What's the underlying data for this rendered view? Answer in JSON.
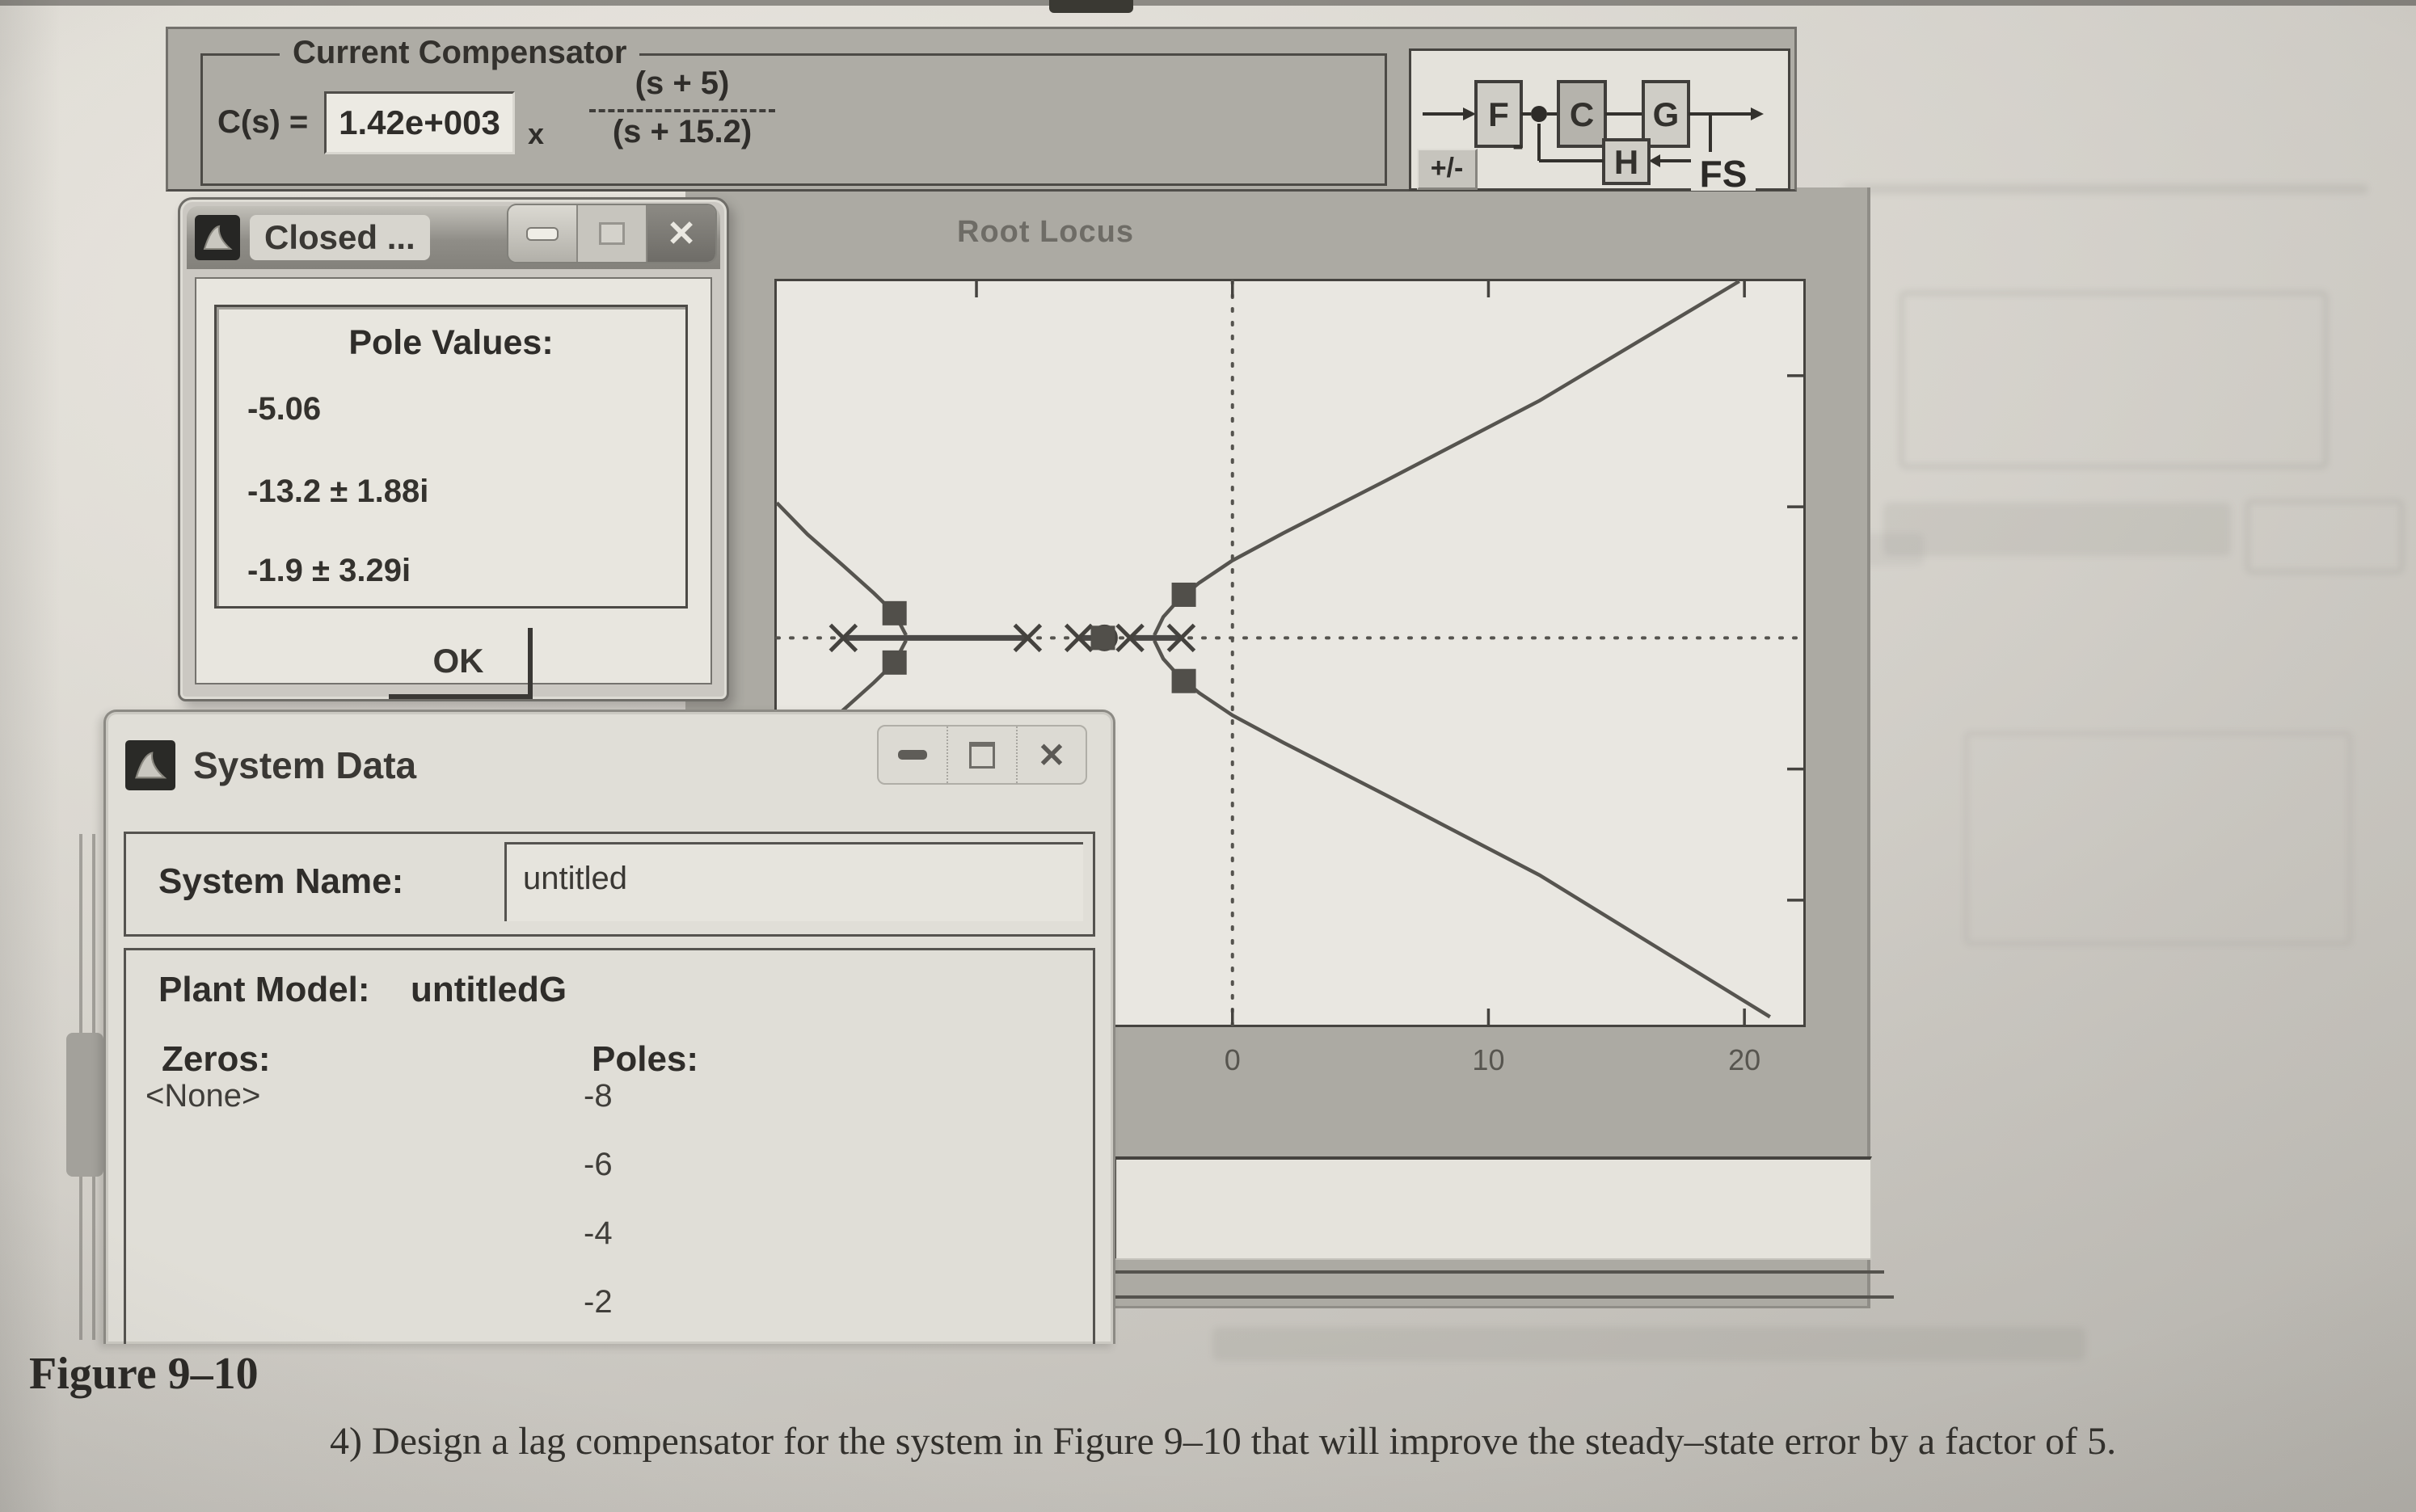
{
  "page": {
    "figure_label": "Figure 9–10",
    "problem_text": "4) Design a lag compensator for the system in Figure 9–10 that will improve the steady–state error by a factor of 5."
  },
  "compensator": {
    "group_label": "Current Compensator",
    "cs_label": "C(s) =",
    "gain_value": "1.42e+003",
    "multiply_sign": "x",
    "numerator": "(s + 5)",
    "denominator": "(s + 15.2)"
  },
  "block_diagram": {
    "block_f": "F",
    "block_c": "C",
    "block_g": "G",
    "block_h": "H",
    "minus_sign": "-",
    "sign_toggle_label": "+/-",
    "fs_label": "FS"
  },
  "closed_dialog": {
    "title": "Closed ...",
    "heading": "Pole Values:",
    "values": [
      "-5.06",
      "-13.2 ± 1.88i",
      "-1.9 ± 3.29i"
    ],
    "ok_label": "OK",
    "close_glyph": "✕"
  },
  "system_data": {
    "title": "System Data",
    "name_label": "System Name:",
    "name_value": "untitled",
    "plant_label": "Plant Model:",
    "plant_value": "untitledG",
    "zeros_label": "Zeros:",
    "zeros": [
      "<None>"
    ],
    "poles_label": "Poles:",
    "poles": [
      "-8",
      "-6",
      "-4",
      "-2"
    ],
    "close_glyph": "✕"
  },
  "chart_data": {
    "type": "scatter",
    "title": "Root Locus",
    "xlabel": "",
    "ylabel": "",
    "xlim": [
      -17.8,
      22.3
    ],
    "ylim": [
      -29.5,
      27.2
    ],
    "grid": false,
    "axes_dashed": true,
    "x_ticks": [
      -10,
      0,
      10,
      20
    ],
    "x_tick_labels": [
      {
        "value": 0,
        "label": "0"
      },
      {
        "value": 10,
        "label": "10"
      },
      {
        "value": 20,
        "label": "20"
      }
    ],
    "y_ticks": [
      -20,
      -10,
      10,
      20
    ],
    "open_loop_poles": [
      [
        -15.2,
        0
      ],
      [
        -8,
        0
      ],
      [
        -6,
        0
      ],
      [
        -4,
        0
      ],
      [
        -2,
        0
      ]
    ],
    "open_loop_zeros": [
      [
        -5,
        0
      ]
    ],
    "closed_loop_poles": [
      [
        -5.06,
        0
      ],
      [
        -13.2,
        1.88
      ],
      [
        -13.2,
        -1.88
      ],
      [
        -1.9,
        3.29
      ],
      [
        -1.9,
        -3.29
      ]
    ],
    "real_axis_segments": [
      [
        -15.2,
        -8
      ],
      [
        -6,
        -5
      ],
      [
        -4,
        -2
      ]
    ],
    "branches": [
      [
        [
          -3.05,
          0.2
        ],
        [
          -2.7,
          1.6
        ],
        [
          -2.1,
          2.9
        ],
        [
          -1.3,
          4.2
        ],
        [
          0,
          5.9
        ],
        [
          2,
          8
        ],
        [
          6,
          12
        ],
        [
          12,
          18.1
        ],
        [
          19.8,
          27.2
        ]
      ],
      [
        [
          -3.05,
          -0.2
        ],
        [
          -2.7,
          -1.6
        ],
        [
          -2.1,
          -2.9
        ],
        [
          -1.3,
          -4.2
        ],
        [
          0,
          -5.9
        ],
        [
          2,
          -8
        ],
        [
          6,
          -12
        ],
        [
          12,
          -18.1
        ],
        [
          21,
          -28.9
        ]
      ],
      [
        [
          -12.75,
          0.2
        ],
        [
          -13.2,
          1.88
        ],
        [
          -14,
          3.4
        ],
        [
          -15.2,
          5.5
        ],
        [
          -16.6,
          7.9
        ],
        [
          -17.8,
          10.3
        ]
      ],
      [
        [
          -12.75,
          -0.2
        ],
        [
          -13.2,
          -1.88
        ],
        [
          -14,
          -3.4
        ],
        [
          -15.2,
          -5.5
        ],
        [
          -16.6,
          -7.9
        ],
        [
          -17.8,
          -10.3
        ]
      ]
    ]
  }
}
